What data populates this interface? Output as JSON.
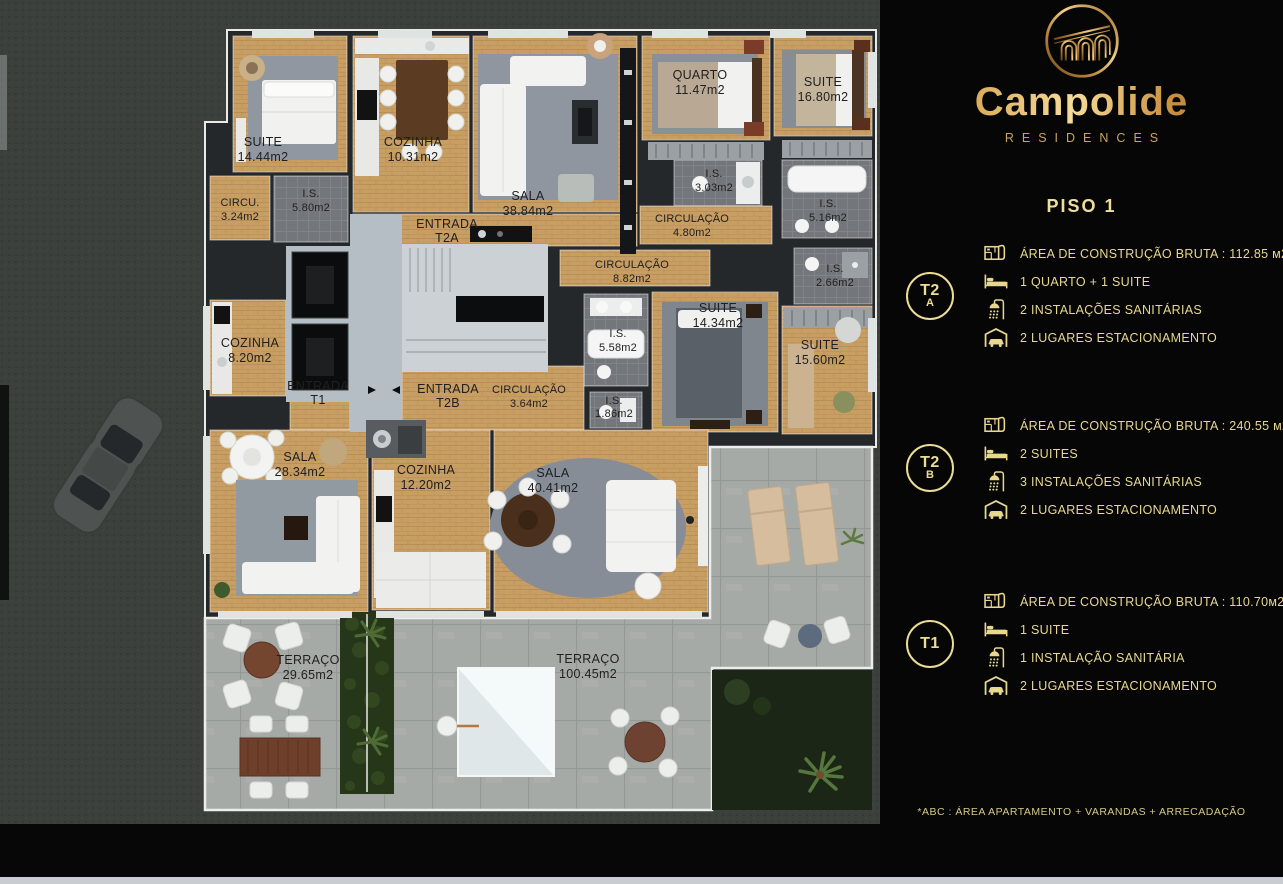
{
  "brand": {
    "name": "Campolide",
    "subtitle": "RESIDENCES",
    "floor_title": "PISO 1",
    "footnote": "*ABC :  ÁREA APARTAMENTO + VARANDAS + ARRECADAÇÃO"
  },
  "colors": {
    "gold_text": "#e8d88f",
    "gold_badge": "#ecdc96",
    "panel_bg": "#060606",
    "wood_floor": "#c89e63",
    "wall": "#25282b",
    "bath_tile": "#73777b",
    "terrace_concrete": "#a6aaa7",
    "ground": "#3b403d"
  },
  "units": [
    {
      "badge_top": "T2",
      "badge_bottom": "A",
      "rows": [
        {
          "icon": "floorplan-icon",
          "text": "ÁREA DE CONSTRUÇÃO BRUTA :  112.85 м2*"
        },
        {
          "icon": "bed-icon",
          "text": "1 QUARTO + 1 SUITE"
        },
        {
          "icon": "shower-icon",
          "text": "2 INSTALAÇÕES SANITÁRIAS"
        },
        {
          "icon": "garage-icon",
          "text": "2 LUGARES ESTACIONAMENTO"
        }
      ]
    },
    {
      "badge_top": "T2",
      "badge_bottom": "B",
      "rows": [
        {
          "icon": "floorplan-icon",
          "text": "ÁREA DE CONSTRUÇÃO BRUTA :  240.55 м2*"
        },
        {
          "icon": "bed-icon",
          "text": "2 SUITES"
        },
        {
          "icon": "shower-icon",
          "text": "3 INSTALAÇÕES SANITÁRIAS"
        },
        {
          "icon": "garage-icon",
          "text": "2 LUGARES ESTACIONAMENTO"
        }
      ]
    },
    {
      "badge_top": "T1",
      "badge_bottom": "",
      "rows": [
        {
          "icon": "floorplan-icon",
          "text": "ÁREA DE CONSTRUÇÃO BRUTA :  110.70м2*"
        },
        {
          "icon": "bed-icon",
          "text": "1 SUITE"
        },
        {
          "icon": "shower-icon",
          "text": "1 INSTALAÇÃO SANITÁRIA"
        },
        {
          "icon": "garage-icon",
          "text": "2 LUGARES ESTACIONAMENTO"
        }
      ]
    }
  ],
  "floor_plan": {
    "rooms": [
      {
        "name": "SUITE",
        "area": "14.44m2"
      },
      {
        "name": "CIRCU.",
        "area": "3.24m2"
      },
      {
        "name": "I.S.",
        "area": "5.80m2"
      },
      {
        "name": "COZINHA",
        "area": "10.31m2"
      },
      {
        "name": "SALA",
        "area": "38.84m2"
      },
      {
        "name": "QUARTO",
        "area": "11.47m2"
      },
      {
        "name": "I.S.",
        "area": "3.03m2"
      },
      {
        "name": "SUITE",
        "area": "16.80m2"
      },
      {
        "name": "I.S.",
        "area": "5.16m2"
      },
      {
        "name": "CIRCULAÇÃO",
        "area": "4.80m2"
      },
      {
        "name": "ENTRADA",
        "area": "T2A"
      },
      {
        "name": "CIRCULAÇÃO",
        "area": "8.82m2"
      },
      {
        "name": "I.S.",
        "area": "2.66m2"
      },
      {
        "name": "SUITE",
        "area": "14.34m2"
      },
      {
        "name": "I.S.",
        "area": "5.58m2"
      },
      {
        "name": "SUITE",
        "area": "15.60m2"
      },
      {
        "name": "COZINHA",
        "area": "8.20m2"
      },
      {
        "name": "ENTRADA",
        "area": "T1"
      },
      {
        "name": "ENTRADA",
        "area": "T2B"
      },
      {
        "name": "CIRCULAÇÃO",
        "area": "3.64m2"
      },
      {
        "name": "I.S.",
        "area": "1.86m2"
      },
      {
        "name": "SALA",
        "area": "28.34m2"
      },
      {
        "name": "COZINHA",
        "area": "12.20m2"
      },
      {
        "name": "SALA",
        "area": "40.41m2"
      },
      {
        "name": "TERRAÇO",
        "area": "29.65m2"
      },
      {
        "name": "TERRAÇO",
        "area": "100.45m2"
      }
    ]
  }
}
